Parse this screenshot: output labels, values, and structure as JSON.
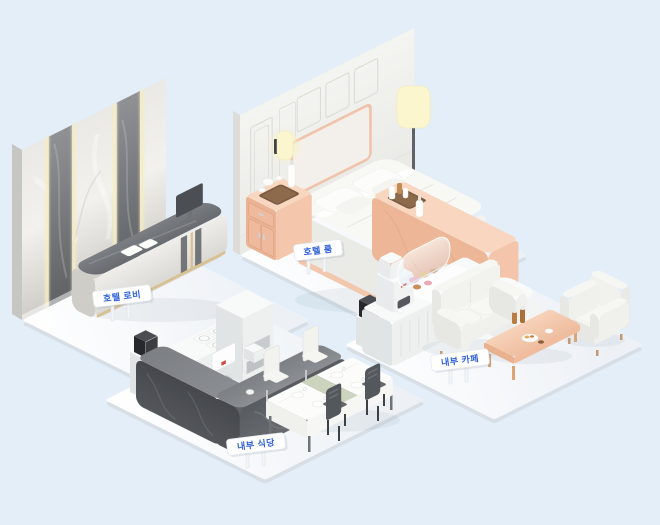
{
  "scene": {
    "background_color": "#e3eef8",
    "label_text_color": "#2f62d8",
    "sign_color": "#ffffff",
    "areas": [
      {
        "id": "hotel-lobby",
        "label": "호텔 로비"
      },
      {
        "id": "hotel-room",
        "label": "호텔 룸"
      },
      {
        "id": "staff-restaurant",
        "label": "내부 식당"
      },
      {
        "id": "staff-cafe",
        "label": "내부 카페"
      }
    ],
    "palette": {
      "floor_white": "#f5f7f9",
      "peach_wood": "#f4c5ab",
      "dark_marble": "#54575b",
      "light_marble": "#dfddd8",
      "lamp_glow": "#fbf2c4"
    }
  }
}
